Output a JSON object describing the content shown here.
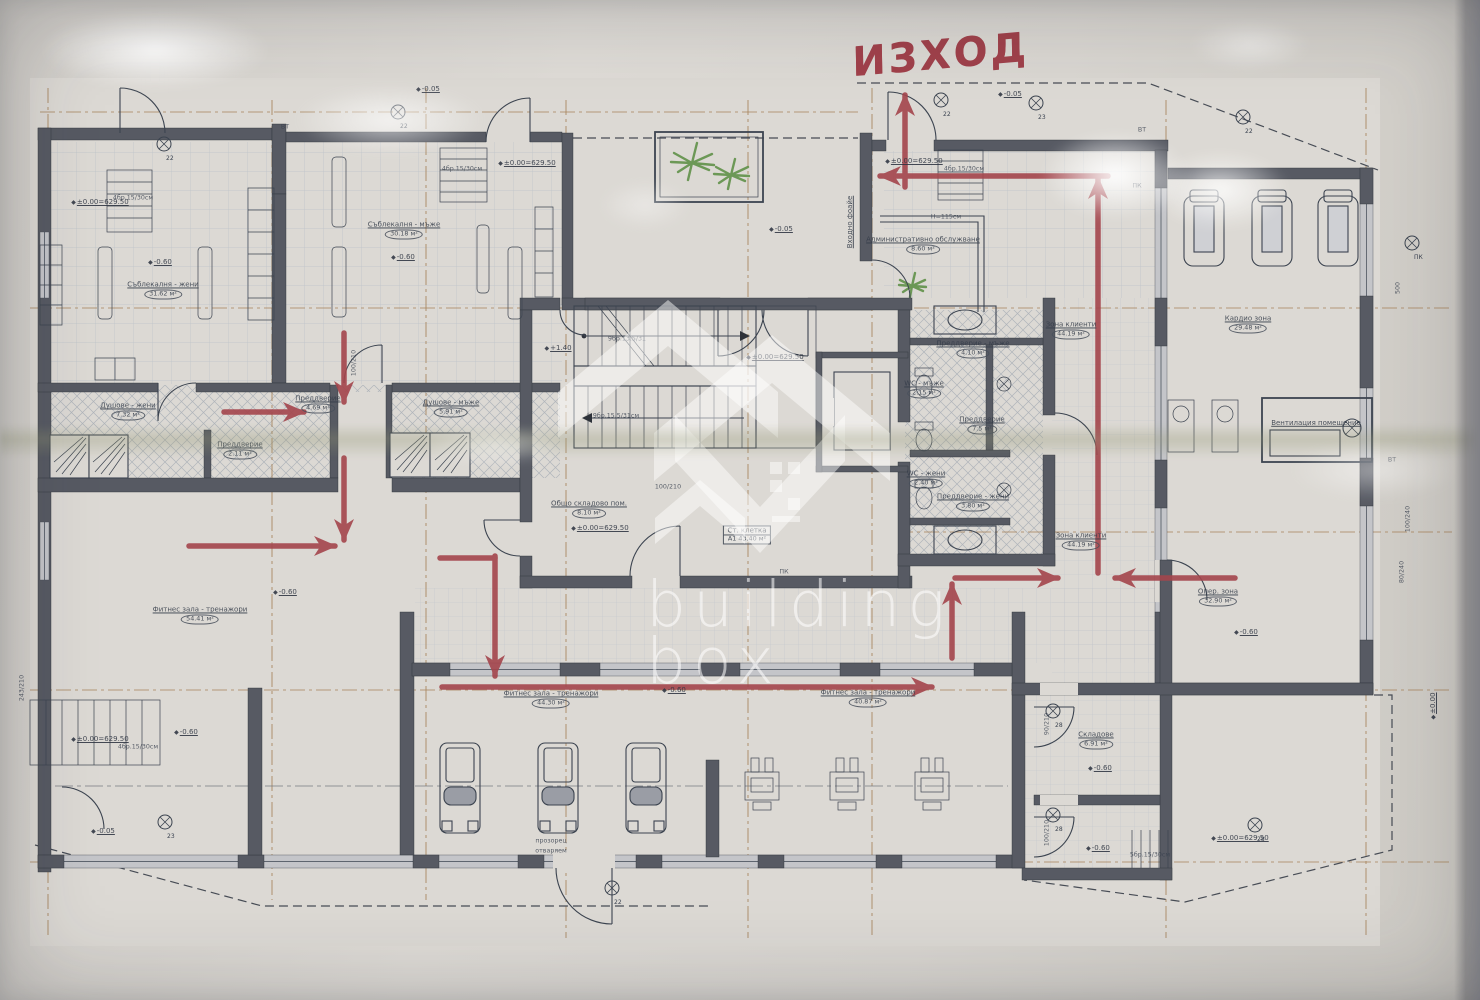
{
  "watermark": {
    "line1": "building",
    "line2": "box",
    "logo": "buildingbox-houses-logo"
  },
  "evacuation": {
    "exit_text": "ИЗХОД",
    "arrow_color": "#a4454c",
    "arrows": [
      {
        "x1": 905,
        "y1": 187,
        "x2": 905,
        "y2": 95
      },
      {
        "x1": 1108,
        "y1": 176,
        "x2": 880,
        "y2": 176
      },
      {
        "x1": 1098,
        "y1": 573,
        "x2": 1098,
        "y2": 178
      },
      {
        "x1": 1235,
        "y1": 578,
        "x2": 1115,
        "y2": 578
      },
      {
        "x1": 955,
        "y1": 578,
        "x2": 1058,
        "y2": 578
      },
      {
        "x1": 952,
        "y1": 658,
        "x2": 952,
        "y2": 584
      },
      {
        "x1": 224,
        "y1": 412,
        "x2": 304,
        "y2": 412
      },
      {
        "x1": 344,
        "y1": 333,
        "x2": 344,
        "y2": 402
      },
      {
        "x1": 344,
        "y1": 458,
        "x2": 344,
        "y2": 540
      },
      {
        "x1": 189,
        "y1": 546,
        "x2": 335,
        "y2": 546
      },
      {
        "x1": 440,
        "y1": 558,
        "x2": 495,
        "y2": 558,
        "head": false
      },
      {
        "x1": 495,
        "y1": 556,
        "x2": 495,
        "y2": 676
      },
      {
        "x1": 442,
        "y1": 687,
        "x2": 932,
        "y2": 687
      }
    ]
  },
  "plan": {
    "room_labels": [
      {
        "name": "Съблекалня - жени",
        "area": "31.62 м²",
        "x": 163,
        "y": 290
      },
      {
        "name": "Съблекалня - мъже",
        "area": "30.18 м²",
        "x": 404,
        "y": 230
      },
      {
        "name": "Душове - жени",
        "area": "7.32 м²",
        "x": 128,
        "y": 411
      },
      {
        "name": "Душове - мъже",
        "area": "5.91 м²",
        "x": 451,
        "y": 408
      },
      {
        "name": "Преддверие",
        "area": "4.69 м²",
        "x": 318,
        "y": 404
      },
      {
        "name": "Преддверие",
        "area": "2.11 м²",
        "x": 240,
        "y": 450
      },
      {
        "name": "Преддверие - мъже",
        "area": "4.10 м²",
        "x": 973,
        "y": 349
      },
      {
        "name": "WC - мъже",
        "area": "2.15 м²",
        "x": 924,
        "y": 389
      },
      {
        "name": "Преддверие",
        "area": "7.5 м²",
        "x": 982,
        "y": 425
      },
      {
        "name": "WC - жени",
        "area": "2.40 м²",
        "x": 926,
        "y": 479
      },
      {
        "name": "Преддверие - жени",
        "area": "3.80 м²",
        "x": 973,
        "y": 502
      },
      {
        "name": "Зона клиенти",
        "area": "44.19 м²",
        "x": 1071,
        "y": 330
      },
      {
        "name": "Зона клиенти",
        "area": "44.19 м²",
        "x": 1081,
        "y": 541
      },
      {
        "name": "Административно обслужване",
        "area": "8.60 м²",
        "x": 923,
        "y": 245
      },
      {
        "name": "Кардио зона",
        "area": "29.48 м²",
        "x": 1248,
        "y": 324
      },
      {
        "name": "Опер. зона",
        "area": "32.90 м²",
        "x": 1218,
        "y": 597
      },
      {
        "name": "Фитнес зала - тренажори",
        "area": "54.41 м²",
        "x": 200,
        "y": 615
      },
      {
        "name": "Фитнес зала - тренажори",
        "area": "44.30 м²",
        "x": 551,
        "y": 699
      },
      {
        "name": "Фитнес зала - тренажори",
        "area": "40.87 м²",
        "x": 868,
        "y": 698
      },
      {
        "name": "Складове",
        "area": "6.91 м²",
        "x": 1096,
        "y": 740
      },
      {
        "name": "Общо складово пом.",
        "area": "8.10 м²",
        "x": 589,
        "y": 509
      },
      {
        "name": "Ст. клетка",
        "area": "А1 43.40 м²",
        "x": 747,
        "y": 535,
        "boxed": true
      },
      {
        "name": "Вентилация помещение",
        "x": 1316,
        "y": 423
      },
      {
        "name": "Входно фоайе",
        "x": 850,
        "y": 222,
        "rot": -90
      }
    ],
    "elevations": [
      {
        "text": "±0.00=629.50",
        "x": 100,
        "y": 202
      },
      {
        "text": "±0.00=629.50",
        "x": 527,
        "y": 163
      },
      {
        "text": "±0.00=629.50",
        "x": 914,
        "y": 161
      },
      {
        "text": "±0.00=629.50",
        "x": 775,
        "y": 357
      },
      {
        "text": "±0.00=629.50",
        "x": 600,
        "y": 528
      },
      {
        "text": "±0.00=629.50",
        "x": 100,
        "y": 739
      },
      {
        "text": "±0.00=629.50",
        "x": 1240,
        "y": 838
      },
      {
        "text": "-0.05",
        "x": 428,
        "y": 89
      },
      {
        "text": "-0.05",
        "x": 1010,
        "y": 94
      },
      {
        "text": "-0.05",
        "x": 781,
        "y": 229
      },
      {
        "text": "-0.05",
        "x": 103,
        "y": 831
      },
      {
        "text": "-0.60",
        "x": 160,
        "y": 262
      },
      {
        "text": "-0.60",
        "x": 403,
        "y": 257
      },
      {
        "text": "-0.60",
        "x": 285,
        "y": 592
      },
      {
        "text": "-0.60",
        "x": 186,
        "y": 732
      },
      {
        "text": "-0.60",
        "x": 674,
        "y": 690
      },
      {
        "text": "-0.60",
        "x": 1246,
        "y": 632
      },
      {
        "text": "-0.60",
        "x": 1100,
        "y": 768
      },
      {
        "text": "-0.60",
        "x": 1098,
        "y": 848
      },
      {
        "text": "+1.40",
        "x": 558,
        "y": 348
      },
      {
        "text": "±0.00",
        "x": 1433,
        "y": 706,
        "rot": -90
      }
    ],
    "small_labels": [
      {
        "text": "4бр.15/30см",
        "x": 133,
        "y": 198
      },
      {
        "text": "4бр.15/30см",
        "x": 462,
        "y": 169
      },
      {
        "text": "4бр.15/30см",
        "x": 964,
        "y": 169
      },
      {
        "text": "4бр.15/30см",
        "x": 138,
        "y": 747
      },
      {
        "text": "5бр.15/30см",
        "x": 1150,
        "y": 855
      },
      {
        "text": "9бр.13.5/31",
        "x": 627,
        "y": 339
      },
      {
        "text": "9бр.15.5/31см",
        "x": 616,
        "y": 416
      },
      {
        "text": "Н=115см",
        "x": 946,
        "y": 217
      },
      {
        "text": "прозорец",
        "x": 551,
        "y": 841
      },
      {
        "text": "отваряем",
        "x": 551,
        "y": 851
      },
      {
        "text": "ПК",
        "x": 784,
        "y": 572
      },
      {
        "text": "ПК",
        "x": 1137,
        "y": 186
      },
      {
        "text": "ВТ",
        "x": 285,
        "y": 127
      },
      {
        "text": "ВТ",
        "x": 1142,
        "y": 130
      },
      {
        "text": "ВТ",
        "x": 1392,
        "y": 460
      },
      {
        "text": "100/210",
        "x": 354,
        "y": 363,
        "rot": -90
      },
      {
        "text": "100/210",
        "x": 668,
        "y": 487
      },
      {
        "text": "90/210",
        "x": 1047,
        "y": 724,
        "rot": -90
      },
      {
        "text": "100/210",
        "x": 1047,
        "y": 833,
        "rot": -90
      },
      {
        "text": "100/240",
        "x": 1408,
        "y": 519,
        "rot": -90
      },
      {
        "text": "80/240",
        "x": 1402,
        "y": 572,
        "rot": -90
      },
      {
        "text": "243/210",
        "x": 22,
        "y": 688,
        "rot": -90
      },
      {
        "text": "500",
        "x": 1398,
        "y": 288,
        "rot": -90
      }
    ],
    "benchmarks": [
      {
        "x": 164,
        "y": 144,
        "num": "22"
      },
      {
        "x": 398,
        "y": 112,
        "num": "22"
      },
      {
        "x": 941,
        "y": 100,
        "num": "22"
      },
      {
        "x": 1036,
        "y": 103,
        "num": "23"
      },
      {
        "x": 1243,
        "y": 117,
        "num": "22"
      },
      {
        "x": 612,
        "y": 888,
        "num": "22"
      },
      {
        "x": 165,
        "y": 822,
        "num": "23"
      },
      {
        "x": 1412,
        "y": 243,
        "num": "ПК"
      },
      {
        "x": 1053,
        "y": 711,
        "num": "28"
      },
      {
        "x": 1053,
        "y": 815,
        "num": "28"
      },
      {
        "x": 1255,
        "y": 825,
        "num": "28"
      }
    ]
  },
  "colors": {
    "arrow": "#a4454c",
    "exit_text": "#9c3540",
    "wall": "#575a63",
    "line": "#3c4450",
    "axis_tan": "#a9865f",
    "plant_green": "#5f9048",
    "paper": "#dcd9d4"
  }
}
